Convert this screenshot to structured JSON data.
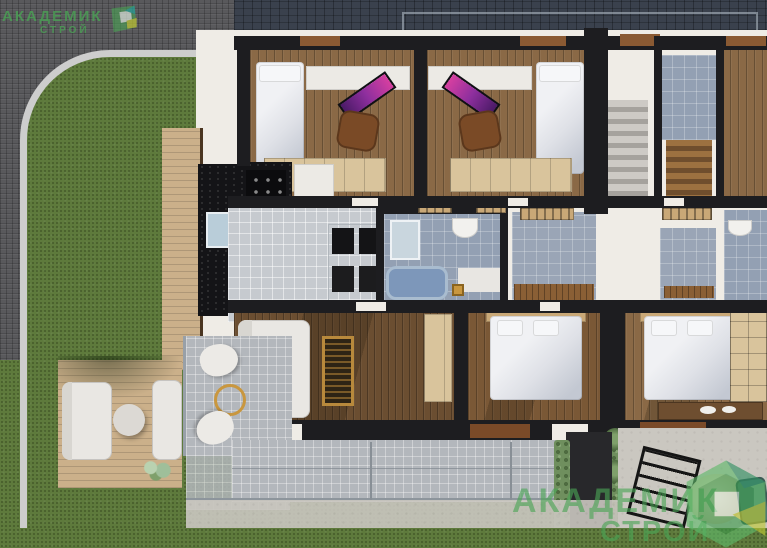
{
  "scene": {
    "kind": "3d-architectural-floorplan-render",
    "view": "top-down cutaway render of mirrored townhouse units with furnished rooms, terraces, lawn and paver street"
  },
  "watermarks": {
    "top_left": {
      "line1": "АКАДЕМИК",
      "line2": "СТРОЙ"
    },
    "bottom_right": {
      "line1": "АКАДЕМИК",
      "line2": "СТРОЙ"
    },
    "logo_name": "akademik-stroy-logo"
  },
  "colors": {
    "brand-green": "#4aa455",
    "pavement": "#59595c",
    "curb": "#cdcdcd",
    "grass": "#5e7a3c",
    "roof": "#3a414d",
    "wall-black": "#1d1d20",
    "wall-white": "#efece6",
    "wood-light": "#8a6946",
    "wood-dark": "#6b4e31",
    "wood-deck": "#cbb08a",
    "tile-gray": "#c6cacf",
    "tile-blue": "#93a0b3",
    "terrace-tile": "#b3b7bc",
    "concrete": "#cac7c0",
    "counter-black": "#141417",
    "cabinet-white": "#eceae5",
    "wardrobe-wood": "#d9c49c",
    "bed-white": "#dfe1e7",
    "headboard-wood": "#c9a877",
    "monitor-purple": "#8e2f9e",
    "chair-brown": "#7a4a26",
    "gold": "#c9973f",
    "plant-green": "#7fa06b"
  }
}
